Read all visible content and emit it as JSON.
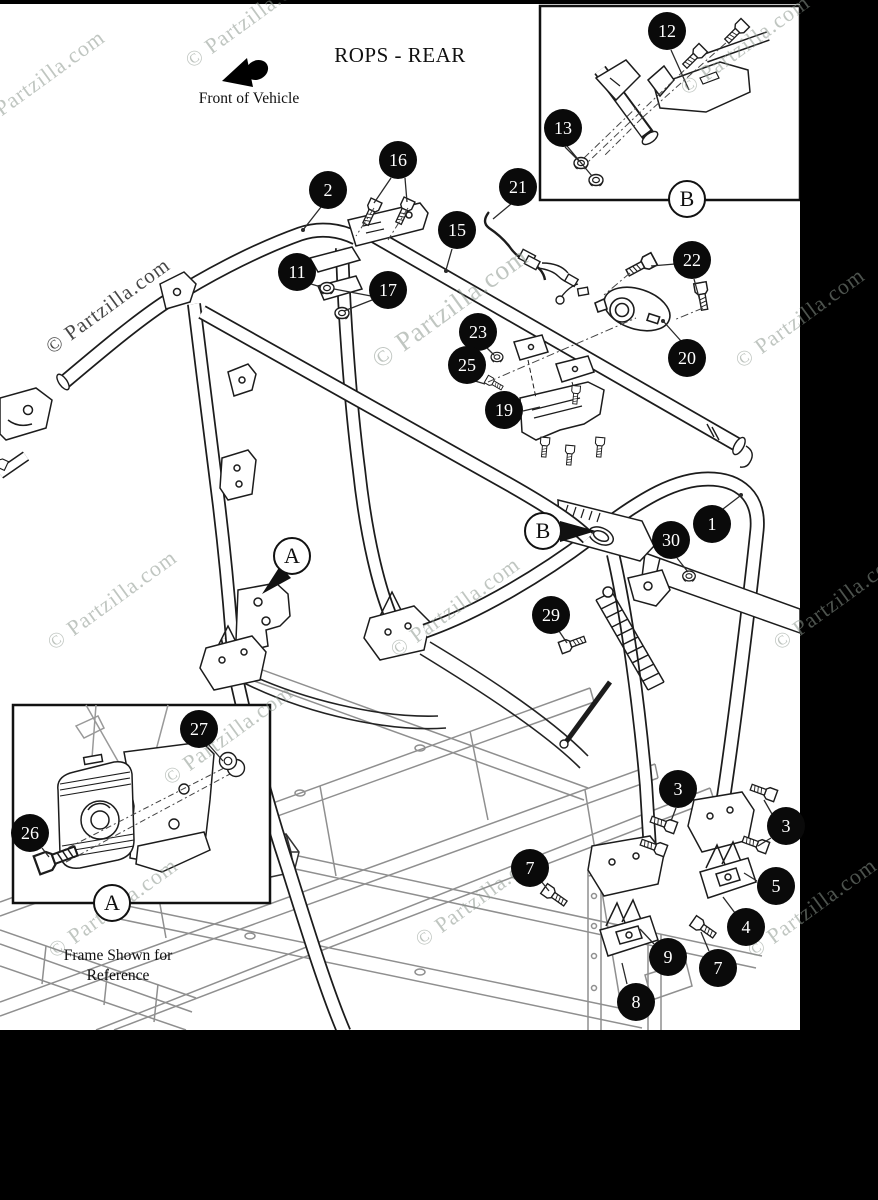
{
  "page": {
    "title": "ROPS - REAR",
    "front_of_vehicle_label": "Front of Vehicle",
    "frame_note_line1": "Frame Shown for",
    "frame_note_line2": "Reference",
    "watermark_text": "© Partzilla.com"
  },
  "detail_refs": {
    "a": "A",
    "b": "B"
  },
  "colors": {
    "canvas_bg": "#000000",
    "paper_bg": "#ffffff",
    "diagram_line": "#1c1c1c",
    "reference_frame_line": "#8f8f8f",
    "callout_bg": "#0a0a0a",
    "callout_text": "#ffffff",
    "watermark_light": "#8c988e",
    "watermark_dark": "#1e1e1e"
  },
  "callouts": [
    {
      "label": "1"
    },
    {
      "label": "2"
    },
    {
      "label": "3"
    },
    {
      "label": "3"
    },
    {
      "label": "4"
    },
    {
      "label": "5"
    },
    {
      "label": "7"
    },
    {
      "label": "7"
    },
    {
      "label": "8"
    },
    {
      "label": "9"
    },
    {
      "label": "11"
    },
    {
      "label": "12"
    },
    {
      "label": "13"
    },
    {
      "label": "15"
    },
    {
      "label": "16"
    },
    {
      "label": "17"
    },
    {
      "label": "19"
    },
    {
      "label": "20"
    },
    {
      "label": "21"
    },
    {
      "label": "22"
    },
    {
      "label": "23"
    },
    {
      "label": "25"
    },
    {
      "label": "26"
    },
    {
      "label": "27"
    },
    {
      "label": "29"
    },
    {
      "label": "30"
    }
  ]
}
